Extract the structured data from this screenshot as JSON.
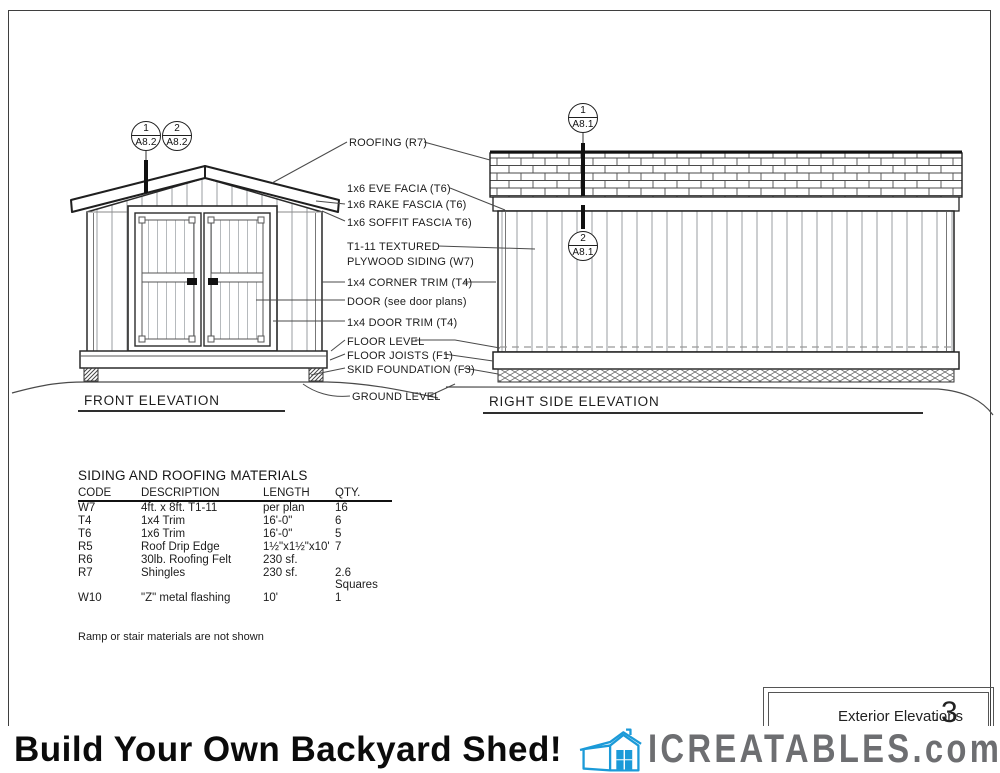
{
  "drawing": {
    "front_elevation": {
      "label": "FRONT ELEVATION",
      "markers": [
        {
          "num": "1",
          "sheet": "A8.2"
        },
        {
          "num": "2",
          "sheet": "A8.2"
        }
      ]
    },
    "right_elevation": {
      "label": "RIGHT SIDE ELEVATION",
      "markers": [
        {
          "num": "1",
          "sheet": "A8.1"
        },
        {
          "num": "2",
          "sheet": "A8.1"
        }
      ]
    },
    "callouts": [
      "ROOFING (R7)",
      "1x6 EVE FACIA (T6)",
      "1x6 RAKE FASCIA (T6)",
      "1x6 SOFFIT FASCIA T6)",
      "T1-11 TEXTURED",
      "PLYWOOD SIDING (W7)",
      "1x4 CORNER TRIM (T4)",
      "DOOR (see door plans)",
      "1x4 DOOR TRIM (T4)",
      "FLOOR LEVEL",
      "FLOOR JOISTS (F1)",
      "SKID FOUNDATION (F3)",
      "GROUND LEVEL"
    ]
  },
  "materials_table": {
    "title": "SIDING AND ROOFING MATERIALS",
    "headers": [
      "CODE",
      "DESCRIPTION",
      "LENGTH",
      "QTY."
    ],
    "rows": [
      [
        "W7",
        "4ft. x 8ft. T1-11",
        "per plan",
        "16"
      ],
      [
        "T4",
        "1x4 Trim",
        "16'-0\"",
        "6"
      ],
      [
        "T6",
        "1x6 Trim",
        "16'-0\"",
        "5"
      ],
      [
        "R5",
        "Roof Drip Edge",
        "1½\"x1½\"x10'",
        "7"
      ],
      [
        "R6",
        "30lb. Roofing Felt",
        "230 sf.",
        ""
      ],
      [
        "R7",
        "Shingles",
        "230 sf.",
        "2.6 Squares"
      ],
      [
        "W10",
        "\"Z\" metal flashing",
        "10'",
        "1"
      ]
    ],
    "note": "Ramp or stair materials are not shown"
  },
  "title_block": {
    "title": "Exterior Elevations",
    "separator": ".",
    "sheet_number": "3"
  },
  "banner": {
    "headline": "Build Your Own Backyard Shed!",
    "brand": "ICREATABLES",
    "brand_suffix": ".com"
  },
  "colors": {
    "logo_blue": "#1b9ad8",
    "brand_gray": "#6d6e71"
  }
}
